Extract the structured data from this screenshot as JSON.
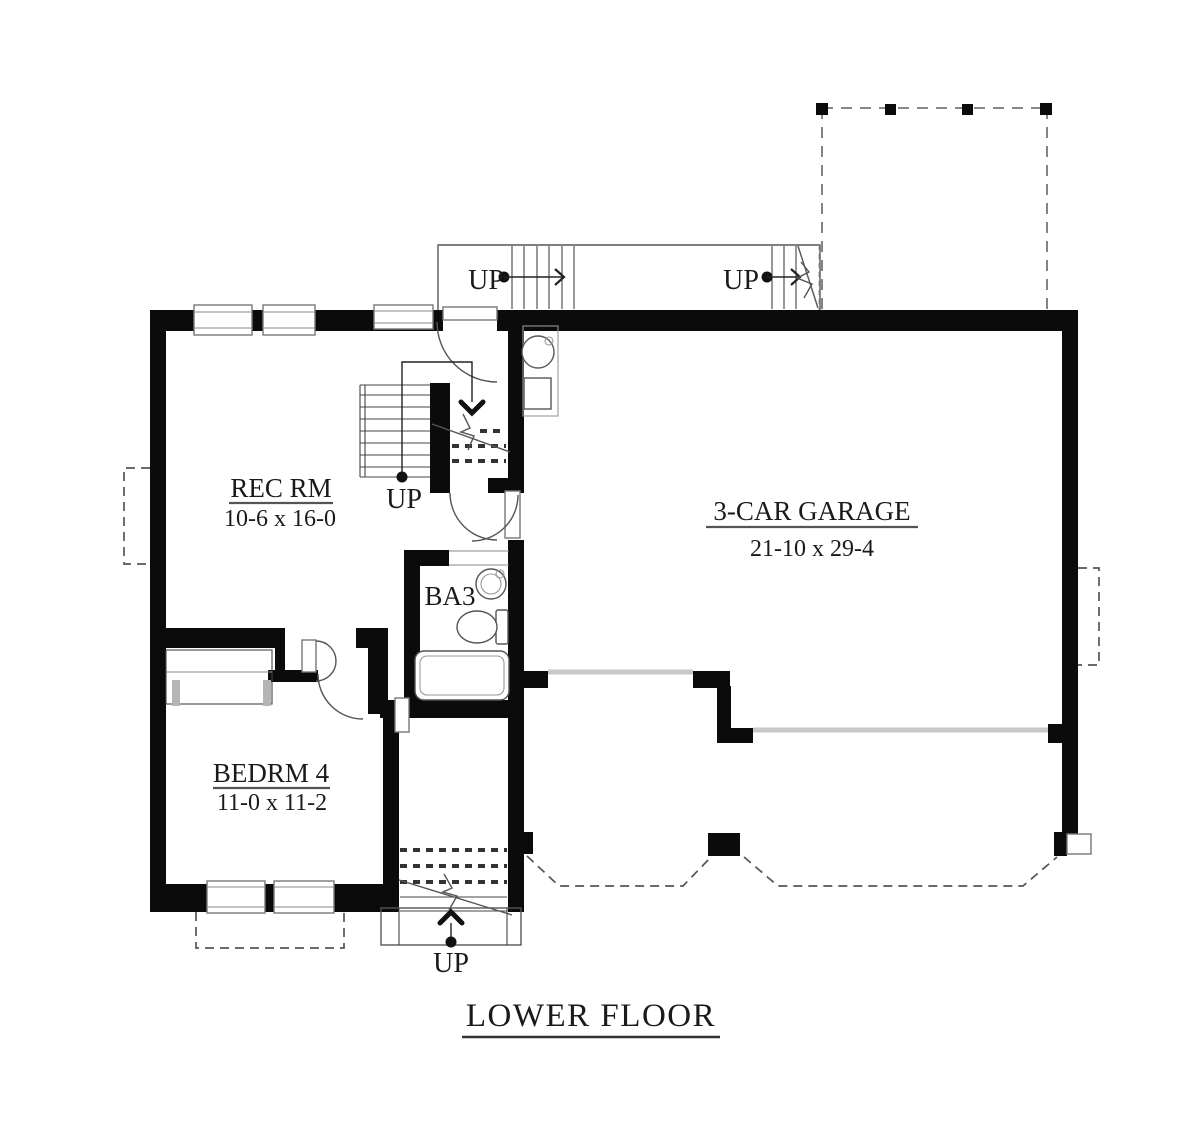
{
  "plan": {
    "title": "LOWER FLOOR",
    "rooms": {
      "rec": {
        "name": "REC RM",
        "dims": "10-6 x 16-0"
      },
      "bedroom": {
        "name": "BEDRM 4",
        "dims": "11-0 x 11-2"
      },
      "bath": {
        "name": "BA3"
      },
      "garage": {
        "name": "3-CAR GARAGE",
        "dims": "21-10 x 29-4"
      }
    },
    "stairs": {
      "upper_west": "UP",
      "upper_east": "UP",
      "main": "UP",
      "entry": "UP"
    },
    "colors": {
      "wall": "#0b0b0b",
      "thin_line": "#444444",
      "window_frame": "#777777",
      "garage_door": "#c8c8c8",
      "dashed_line": "#555555",
      "text": "#1a1a1a"
    }
  }
}
